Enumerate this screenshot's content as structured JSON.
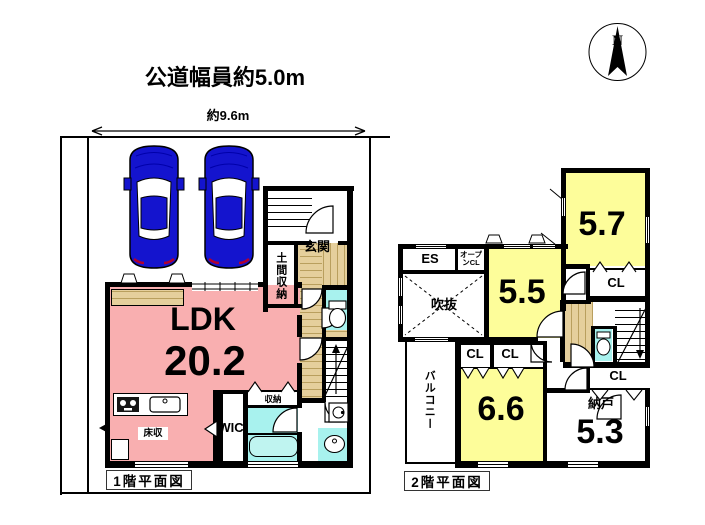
{
  "page": {
    "road_width_label": "公道幅員約5.0m",
    "lot_width_label": "約9.6m",
    "compass_north": "N"
  },
  "floor1": {
    "caption": "1階平面図",
    "labels": {
      "ldk": "LDK",
      "ldk_area": "20.2",
      "genkan": "玄関",
      "doma_storage": "土間収納",
      "storage": "収納",
      "floor_storage": "床収",
      "wic": "WIC"
    }
  },
  "floor2": {
    "caption": "2階平面図",
    "labels": {
      "es": "ES",
      "open_closet": "オープンCL",
      "void": "吹抜",
      "balcony": "バルコニー",
      "closet": "CL",
      "storeroom": "納戸",
      "storeroom_area": "5.3",
      "bedroom_a": "5.5",
      "bedroom_b": "5.7",
      "bedroom_c": "6.6"
    }
  },
  "colors": {
    "wall": "#000000",
    "ldk": "#F9AFB0",
    "room": "#FDFD9A",
    "water": "#A8F2EE",
    "tub": "#BFF4F0",
    "wood": "#E5CF9C",
    "wood_line": "#B99F5E",
    "car": "#1414CE"
  }
}
